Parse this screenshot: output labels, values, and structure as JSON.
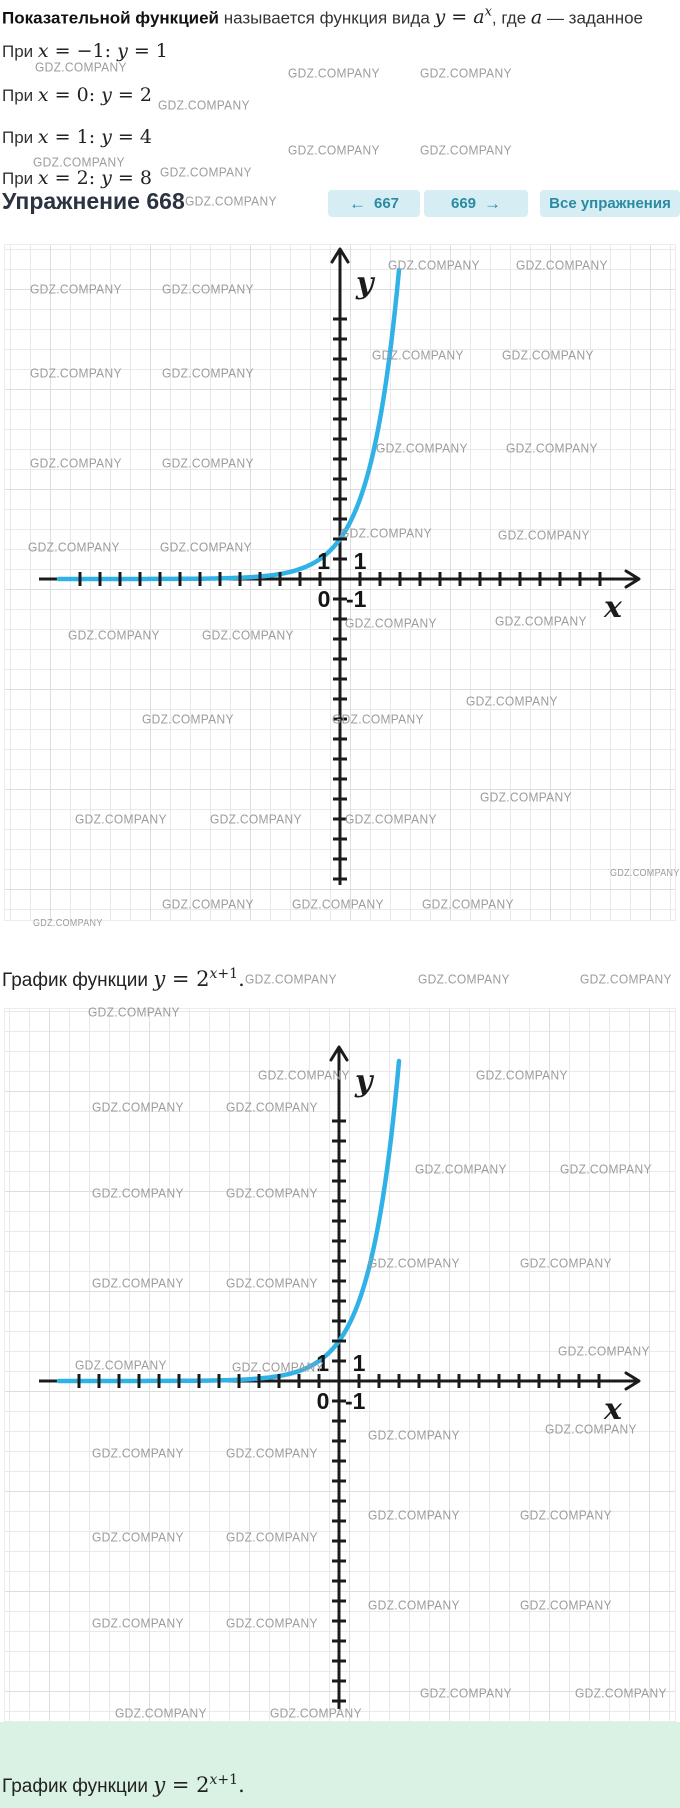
{
  "watermark_text": "GDZ.COMPANY",
  "colors": {
    "curve": "#31b2e6",
    "axis": "#1b1b1b",
    "grid_minor": "#e9e9e9",
    "grid_major": "#dedede",
    "watermark": "#9c9c9c",
    "green_bar": "#d9f2e3",
    "button_bg": "#d7edf4",
    "button_fg": "#2a8ba1",
    "heading": "#2a333f",
    "text": "#333333"
  },
  "intro": {
    "bold": "Показательной функцией",
    "t1": " называется функция вида ",
    "y": "y",
    "eq": " = ",
    "a": "a",
    "sup": "x",
    "t2": ", где ",
    "a2": "a",
    "t3": " — заданное"
  },
  "cases": [
    {
      "pre": "При ",
      "x": "x",
      "mid": " = −1: ",
      "y": "y",
      "val": " = 1"
    },
    {
      "pre": "При ",
      "x": "x",
      "mid": " = 0: ",
      "y": "y",
      "val": " = 2"
    },
    {
      "pre": "При ",
      "x": "x",
      "mid": " = 1: ",
      "y": "y",
      "val": " = 4"
    },
    {
      "pre": "При ",
      "x": "x",
      "mid": " = 2: ",
      "y": "y",
      "val": " = 8"
    }
  ],
  "exercise": {
    "heading": "Упражнение 668"
  },
  "nav": {
    "prev_arrow": "←",
    "prev_label": "667",
    "next_label": "669",
    "next_arrow": "→",
    "all_label": "Все упражнения"
  },
  "captions": {
    "between": {
      "pre": "График функции ",
      "y": "y",
      "eq": " = ",
      "base": "2",
      "sup_x": "x",
      "sup_rest": "+1",
      "dot": "."
    },
    "final": {
      "pre": "График функции ",
      "y": "y",
      "eq": " = ",
      "base": "2",
      "sup_x": "x",
      "sup_rest": "+1",
      "dot": "."
    }
  },
  "chart_data": [
    {
      "type": "line",
      "title": "График функции y = 2^(x+1)",
      "formula": "y = 2^(x+1)",
      "key_points": [
        {
          "x": -1,
          "y": 1
        },
        {
          "x": 0,
          "y": 2
        },
        {
          "x": 1,
          "y": 4
        },
        {
          "x": 2,
          "y": 8
        }
      ],
      "x_visible_range": [
        -15,
        15
      ],
      "y_visible_range": [
        -17.1,
        16.5
      ],
      "xlabel": "x",
      "ylabel": "y",
      "grid": true,
      "shown_axis_numbers": [
        "1",
        "1",
        "0",
        "-1"
      ],
      "curve_color": "#31b2e6"
    },
    {
      "type": "line",
      "title": "График функции y = 2^(x+1)",
      "formula": "y = 2^(x+1)",
      "key_points": [
        {
          "x": -1,
          "y": 1
        },
        {
          "x": 0,
          "y": 2
        },
        {
          "x": 1,
          "y": 4
        },
        {
          "x": 2,
          "y": 8
        }
      ],
      "x_visible_range": [
        -15,
        15
      ],
      "y_visible_range": [
        -17.4,
        18.6
      ],
      "xlabel": "x",
      "ylabel": "y",
      "grid": true,
      "shown_axis_numbers": [
        "1",
        "1",
        "0",
        "-1"
      ],
      "curve_color": "#31b2e6"
    }
  ],
  "graphs": [
    {
      "panel": {
        "left": 4,
        "top": 244,
        "width": 672,
        "height": 677
      },
      "grid_offset": [
        5,
        4
      ],
      "grid_offset_major": [
        45,
        44
      ],
      "ox": 335,
      "oy": 334,
      "unit": 20,
      "x_axis": {
        "start": 34,
        "end": 634,
        "ticks_left": 13,
        "ticks_right": 13
      },
      "y_axis": {
        "tip": 4,
        "end": 640,
        "ticks_up": 13,
        "ticks_down": 15
      },
      "curve": {
        "x_start": 54,
        "x_end": 398,
        "min_y": 5
      },
      "labels": {
        "y": "y",
        "x": "x",
        "one_left": "1",
        "one_right": "1",
        "zero": "0",
        "minus_one": "-1"
      }
    },
    {
      "panel": {
        "left": 4,
        "top": 1008,
        "width": 672,
        "height": 714
      },
      "grid_offset": [
        4,
        2
      ],
      "grid_offset_major": [
        44,
        82
      ],
      "ox": 334,
      "oy": 372,
      "unit": 20,
      "x_axis": {
        "start": 34,
        "end": 634,
        "ticks_left": 13,
        "ticks_right": 13
      },
      "y_axis": {
        "tip": 38,
        "end": 700,
        "ticks_up": 13,
        "ticks_down": 16
      },
      "curve": {
        "x_start": 54,
        "x_end": 398,
        "min_y": 39
      },
      "labels": {
        "y": "y",
        "x": "x",
        "one_left": "1",
        "one_right": "1",
        "zero": "0",
        "minus_one": "-1"
      }
    }
  ],
  "watermarks": [
    [
      35,
      60
    ],
    [
      288,
      66
    ],
    [
      420,
      66
    ],
    [
      158,
      98
    ],
    [
      33,
      155
    ],
    [
      288,
      143
    ],
    [
      420,
      143
    ],
    [
      160,
      165
    ],
    [
      185,
      194
    ],
    [
      388,
      258
    ],
    [
      516,
      258
    ],
    [
      30,
      282
    ],
    [
      162,
      282
    ],
    [
      372,
      348
    ],
    [
      502,
      348
    ],
    [
      30,
      366
    ],
    [
      162,
      366
    ],
    [
      376,
      441
    ],
    [
      506,
      441
    ],
    [
      30,
      456
    ],
    [
      162,
      456
    ],
    [
      340,
      526
    ],
    [
      498,
      528
    ],
    [
      28,
      540
    ],
    [
      160,
      540
    ],
    [
      345,
      616
    ],
    [
      495,
      614
    ],
    [
      68,
      628
    ],
    [
      202,
      628
    ],
    [
      142,
      712
    ],
    [
      332,
      712
    ],
    [
      466,
      694
    ],
    [
      75,
      812
    ],
    [
      210,
      812
    ],
    [
      345,
      812
    ],
    [
      480,
      790
    ],
    [
      610,
      868,
      9
    ],
    [
      162,
      897
    ],
    [
      292,
      897
    ],
    [
      422,
      897
    ],
    [
      33,
      918,
      9
    ],
    [
      245,
      972
    ],
    [
      418,
      972
    ],
    [
      580,
      972
    ],
    [
      88,
      1005
    ],
    [
      258,
      1068
    ],
    [
      476,
      1068
    ],
    [
      92,
      1100
    ],
    [
      226,
      1100
    ],
    [
      415,
      1162
    ],
    [
      560,
      1162
    ],
    [
      92,
      1186
    ],
    [
      226,
      1186
    ],
    [
      368,
      1256
    ],
    [
      520,
      1256
    ],
    [
      92,
      1276
    ],
    [
      226,
      1276
    ],
    [
      558,
      1344
    ],
    [
      75,
      1358
    ],
    [
      232,
      1360
    ],
    [
      545,
      1422
    ],
    [
      368,
      1428
    ],
    [
      92,
      1446
    ],
    [
      226,
      1446
    ],
    [
      368,
      1508
    ],
    [
      520,
      1508
    ],
    [
      92,
      1530
    ],
    [
      226,
      1530
    ],
    [
      368,
      1598
    ],
    [
      520,
      1598
    ],
    [
      92,
      1616
    ],
    [
      226,
      1616
    ],
    [
      420,
      1686
    ],
    [
      575,
      1686
    ],
    [
      115,
      1706
    ],
    [
      270,
      1706
    ]
  ]
}
